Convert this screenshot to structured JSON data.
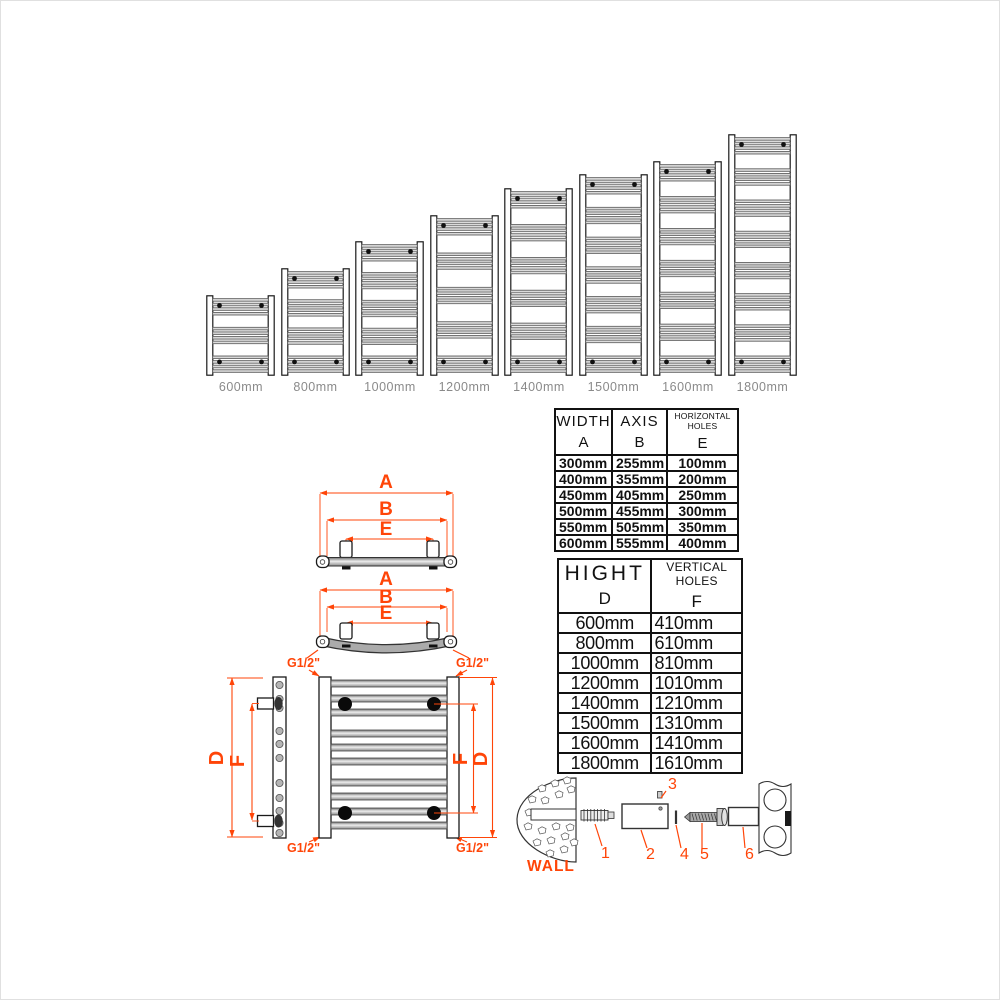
{
  "colors": {
    "accent": "#FF4508",
    "bar_gray": "#b8b8b8",
    "label_gray": "#8a8a8a",
    "line_black": "#1a1a1a"
  },
  "lineup": {
    "items": [
      {
        "label": "600mm",
        "height_mm": 600
      },
      {
        "label": "800mm",
        "height_mm": 800
      },
      {
        "label": "1000mm",
        "height_mm": 1000
      },
      {
        "label": "1200mm",
        "height_mm": 1200
      },
      {
        "label": "1400mm",
        "height_mm": 1400
      },
      {
        "label": "1500mm",
        "height_mm": 1500
      },
      {
        "label": "1600mm",
        "height_mm": 1600
      },
      {
        "label": "1800mm",
        "height_mm": 1800
      }
    ]
  },
  "dimension_labels": {
    "width": "A",
    "axis": "B",
    "horizontal_holes": "E",
    "height": "D",
    "vertical_holes": "F",
    "thread": "G1/2\""
  },
  "width_table": {
    "col1_title": "WIDTH",
    "col1_letter": "A",
    "col2_title": "AXIS",
    "col2_letter": "B",
    "col3_title": "HORİZONTAL HOLES",
    "col3_letter": "E",
    "rows": [
      [
        "300mm",
        "255mm",
        "100mm"
      ],
      [
        "400mm",
        "355mm",
        "200mm"
      ],
      [
        "450mm",
        "405mm",
        "250mm"
      ],
      [
        "500mm",
        "455mm",
        "300mm"
      ],
      [
        "550mm",
        "505mm",
        "350mm"
      ],
      [
        "600mm",
        "555mm",
        "400mm"
      ]
    ]
  },
  "height_table": {
    "col1_title": "HIGHT",
    "col1_letter": "D",
    "col2_title": "VERTICAL HOLES",
    "col2_letter": "F",
    "rows": [
      [
        "600mm",
        "410mm"
      ],
      [
        "800mm",
        "610mm"
      ],
      [
        "1000mm",
        "810mm"
      ],
      [
        "1200mm",
        "1010mm"
      ],
      [
        "1400mm",
        "1210mm"
      ],
      [
        "1500mm",
        "1310mm"
      ],
      [
        "1600mm",
        "1410mm"
      ],
      [
        "1800mm",
        "1610mm"
      ]
    ]
  },
  "hardware": {
    "wall_label": "WALL",
    "parts": [
      "1",
      "2",
      "3",
      "4",
      "5",
      "6"
    ]
  }
}
